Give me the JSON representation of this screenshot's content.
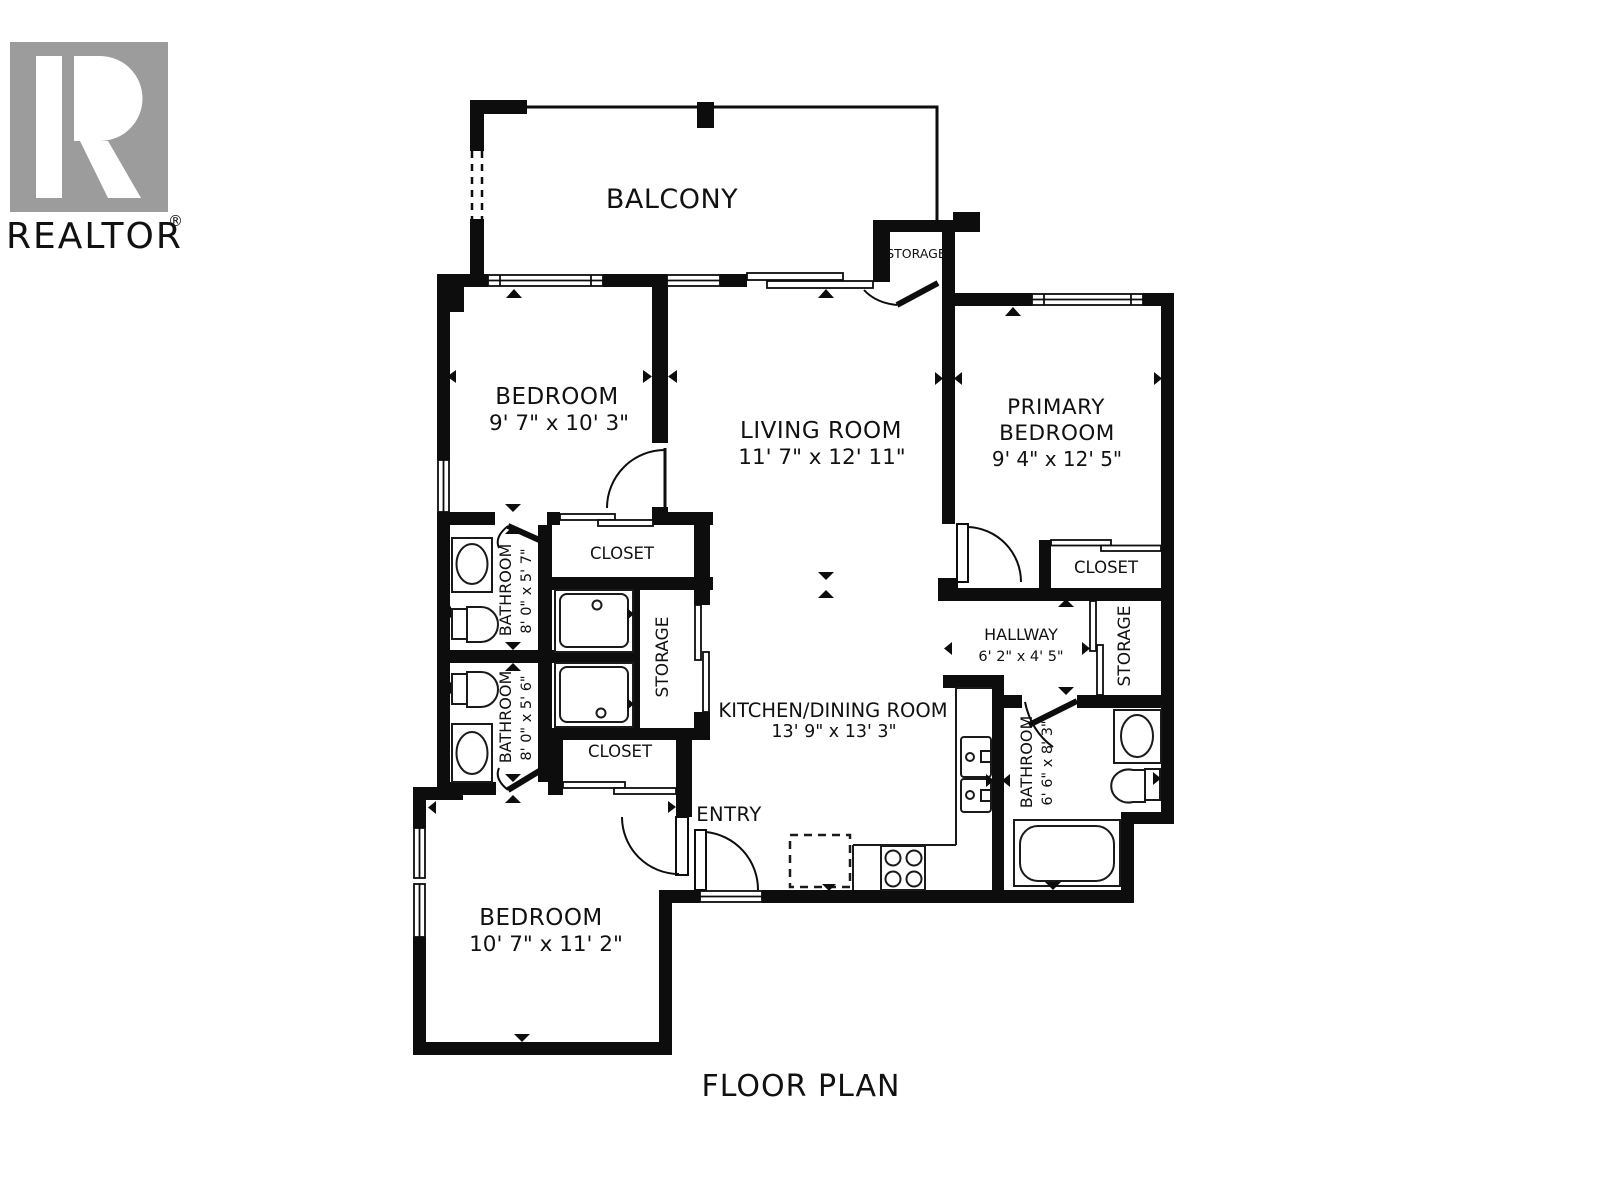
{
  "title": "FLOOR PLAN",
  "logo": {
    "brand": "REALTOR",
    "registered": "®"
  },
  "colors": {
    "wall": "#0d0d0d",
    "logo_gray": "#9c9c9c",
    "background": "#ffffff"
  },
  "rooms": {
    "balcony": {
      "label": "BALCONY"
    },
    "storage_balcony": {
      "label": "STORAGE"
    },
    "bedroom_top": {
      "label": "BEDROOM",
      "dims": "9' 7\" x 10' 3\""
    },
    "living_room": {
      "label": "LIVING ROOM",
      "dims": "11' 7\" x 12' 11\""
    },
    "primary_bedroom": {
      "label_line1": "PRIMARY",
      "label_line2": "BEDROOM",
      "dims": "9' 4\" x 12' 5\""
    },
    "closet_top": {
      "label": "CLOSET"
    },
    "closet_bottom": {
      "label": "CLOSET"
    },
    "closet_primary": {
      "label": "CLOSET"
    },
    "storage_left": {
      "label": "STORAGE"
    },
    "storage_hallway": {
      "label": "STORAGE"
    },
    "bathroom_top": {
      "label": "BATHROOM",
      "dims": "8' 0\" x 5' 7\""
    },
    "bathroom_mid": {
      "label": "BATHROOM",
      "dims": "8' 0\" x 5' 6\""
    },
    "bathroom_right": {
      "label": "BATHROOM",
      "dims": "6' 6\" x 8' 3\""
    },
    "hallway": {
      "label": "HALLWAY",
      "dims": "6' 2\" x 4' 5\""
    },
    "kitchen": {
      "label": "KITCHEN/DINING ROOM",
      "dims": "13' 9\" x 13' 3\""
    },
    "entry": {
      "label": "ENTRY"
    },
    "bedroom_bottom": {
      "label": "BEDROOM",
      "dims": "10' 7\" x 11' 2\""
    }
  }
}
